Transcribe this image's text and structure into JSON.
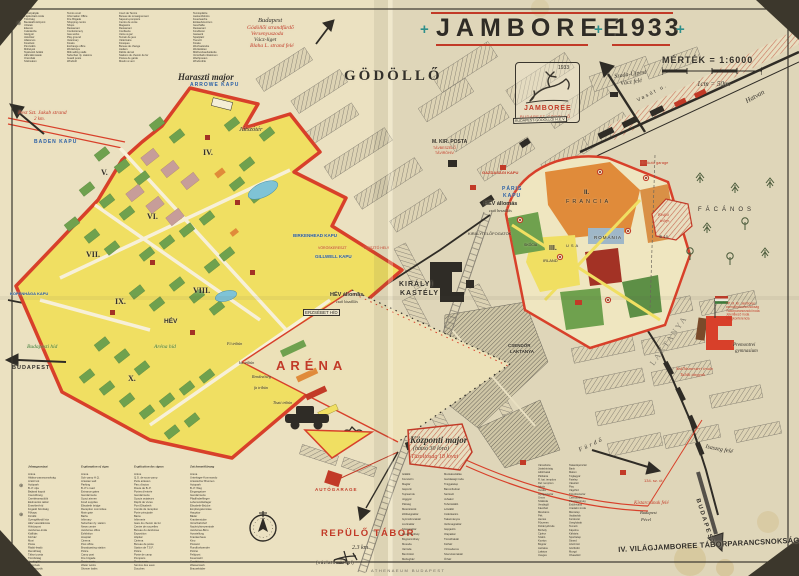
{
  "palette": {
    "paper": "#e8dfc1",
    "photo_bg": "#3c372c",
    "red": "#c23a27",
    "teal": "#2f8f8a",
    "blue": "#2a5fa5",
    "camp_yellow": "#f0df62",
    "green": "#6fa14e",
    "orange": "#e08b3a",
    "ink": "#33302a"
  },
  "header": {
    "plus": "+",
    "title_word": "JAMBOREE",
    "title_year": "1933",
    "scale_label": "MÉRTÉK = 1:6000",
    "scale_note": "1cm = 50m.",
    "town": "GÖDÖLLŐ",
    "logo_year": "1933",
    "logo_name": "JAMBOREE",
    "logo_sub": "BUDAPEST-GÖDÖLLŐ"
  },
  "directions": {
    "top_l1": "Budapest",
    "top_l2": "Gödöllői strandfürdő",
    "top_l3": "Versenyuszoda",
    "top_l4": "Vácz-liget",
    "top_l5": "Blaha L. strand felé",
    "szada_l1": "Szada-Újpest",
    "szada_l2": "Vácz felé",
    "hatvan": "Hatvan",
    "vasut_street": "Vasút u.",
    "jakab_l1": "Pest Szt. Jakab strand",
    "jakab_l2": "2 km.",
    "isaszeg": "Isaszeg felé",
    "budapest_left": "BUDAPEST",
    "budapest_right": "BUDAPEST",
    "kistarcsa": "Kistarcsának felé",
    "kistarcsa_sub1": "Budapest",
    "kistarcsa_sub2": "Pécel",
    "road134": "134. sz. út"
  },
  "camp": {
    "major": "Haraszti major",
    "playground": "Játszótér",
    "regions": [
      "IV.",
      "V.",
      "VI.",
      "VII.",
      "VIII.",
      "IX.",
      "X."
    ],
    "arena": "ARÉNA",
    "arena_bridge": "Aréna híd",
    "budapest_bridge": "Budapesti híd",
    "hev": "HÉV",
    "hev_out": "HÉV állomás",
    "hev_out_note": "csak kiszállás",
    "erzsebet_bridge": "ERZSÉBET HÍD",
    "tribunes": [
      "Fő tribün",
      "kis tribün",
      "Rendezőség",
      "fa tribün",
      "Tiszti tribün"
    ]
  },
  "gates": {
    "arrowe": "ARROWE KAPU",
    "baden": "BADEN KAPU",
    "kopenhaga": "KOPENHÁGA KAPU",
    "birkenhead": "BIRKENHEAD KAPU",
    "gillwell": "GILLWELL KAPU",
    "voroskereszt": "VÖRÖSKERESZT",
    "kioszto": "KIOSZTÓ HELY",
    "paris_1": "PÁRIS",
    "paris_2": "KAPU",
    "gazdasagi": "GAZDASÁGI KAPU"
  },
  "town": {
    "castle_1": "KIRÁLYI",
    "castle_2": "KASTÉLY",
    "posta": "M. KIR. POSTA",
    "posta_red_1": "TÁVBESZÉLŐ",
    "posta_red_2": "TÁVIRÓHIV.",
    "hev_in": "HÉV állomás",
    "hev_in_note": "csak beszállás",
    "hev_line_box": "BUDAPEST-GÖDÖLLŐI H.É.V.",
    "elofogatok": "KIRÁLYI ELŐFOGATOK",
    "csendor_1": "CSENDŐR",
    "csendor_2": "LAKTANYA",
    "laktanya_big": "LAKTANYA",
    "furdo_street": "Fürdő",
    "facanos": "FÁCÁNOS",
    "kisfiu_1": "Kisfiú",
    "kisfiu_2": "telep.",
    "marker10": "⊛ 10.",
    "tp_garage": "TP. Autó garage",
    "francia": "FRANCIA",
    "francia_num": "II.",
    "romania": "ROMÁNIA",
    "camp3_num": "III.",
    "camp3": "IRLAND",
    "usa": "USA",
    "skocia": "SKÓCIA",
    "tp_hq": [
      "TP. M. kir. Jamboree",
      "csendőrparancsnokság",
      "Táborparancsnoki iroda",
      "Jelentkező iroda",
      "Világkonferencia"
    ],
    "gimnazium_1": "Premontrei",
    "gimnazium_2": "gymnasium",
    "szallas_1": "Szállásmesteri iroda",
    "szallas_2": "Talált tárgyak"
  },
  "bottom": {
    "kozponti": "Központi major",
    "kozponti_2": "(hátsó 30 lóra)",
    "kozponti_3": "Tüzoltóság 18 lovai",
    "autogarage": "AUTÓGARAGE",
    "repulo": "REPÜLŐ TÁBOR",
    "repulo_km": "2.3 km",
    "repulo_note": "(vázlaton kívül)",
    "printer": "ATHENAEUM BUDAPEST",
    "command": "IV. VILÁGJAMBOREE TÁBORPARANCSNOKSÁG"
  },
  "legend_top": {
    "hu": [
      "Teniszpályák",
      "Tájékoztató iroda",
      "Tűzőrség",
      "Bevásárló központ",
      "Üzletek",
      "Étterem",
      "Cukrászda",
      "Gázgyár",
      "Játszótér",
      "Állatorvos",
      "Kioszkok",
      "Pénzváltó",
      "Műhelyek",
      "Tejárusító bódék",
      "HÉV-állomások",
      "Őrszobák",
      "Szélmalom"
    ],
    "en": [
      "Tennis court",
      "Information Office",
      "Fire Brigade",
      "Shopping centre",
      "Shops",
      "Restaurant",
      "Confectionery",
      "Gas works",
      "Play ground",
      "Veterinary",
      "Kiosks",
      "Exchange office",
      "Workshops",
      "Milk selling stalls",
      "Suburban rly. stations",
      "Guard posts",
      "Windmill"
    ],
    "fr": [
      "Court de Tennis",
      "Bureau de renseignement",
      "Sapeurs-pompiers",
      "Centre de vente",
      "Magasins",
      "Restaurant",
      "Confiserie",
      "Usine à gaz",
      "Terrain de jeux",
      "Vétérinaire",
      "Kiosques",
      "Bureau de change",
      "Ateliers",
      "Débits de lait",
      "Stations du chemin de fer",
      "Postes de garde",
      "Moulin à vent"
    ],
    "de": [
      "Tennisplätze",
      "Auskunftsbüro",
      "Feuerwache",
      "Einkaufszentrum",
      "Geschäfte",
      "Restaurant",
      "Konditorei",
      "Gaswerk",
      "Spielplatz",
      "Tierarzt",
      "Kioske",
      "Wechselstube",
      "Werkstätten",
      "Milchverkaufsstände",
      "Vorortbahn-Stationen",
      "Wachposten",
      "Windmühle"
    ]
  },
  "legend_bottom": {
    "headers": [
      "Jelmagyarázat",
      "Explanation of signs",
      "Explication des signes",
      "Zeichenerklärung"
    ],
    "hu": [
      "Aréna",
      "Altábor-parancsnokság",
      "Artézi kút",
      "Autópark",
      "B.-P. útja",
      "Bejárati kapuk",
      "Csendőrség",
      "Cserkészrepülők",
      "Élelmezési raktár",
      "Erzsébet-híd",
      "Fogadó bizottság",
      "Főkapu",
      "Fürdők",
      "Gyengélkedő ház",
      "HÉV vasútállomás",
      "Hírközpont",
      "Jamboree-iroda",
      "Kiállítás",
      "Kórház",
      "Mozi",
      "Posta",
      "Rádió-leadó",
      "Rendőrség",
      "Tábori posta",
      "Tüzoltóság",
      "Vendéglők",
      "Vízművek",
      "Zuhanyozók"
    ],
    "en": [
      "Arena",
      "Sub-camp H.Q.",
      "Artesian well",
      "Parking",
      "B.-P.'s road",
      "Entrance gates",
      "Gendarmerie",
      "Scout airmen",
      "Food supplies",
      "Elisabeth bridge",
      "Reception committee",
      "Main gate",
      "Baths",
      "Infirmary",
      "Suburban rly. station",
      "News centre",
      "Jamboree office",
      "Exhibition",
      "Hospital",
      "Cinema",
      "Post office",
      "Broadcasting station",
      "Police",
      "Camp post",
      "Fire brigade",
      "Restaurants",
      "Water works",
      "Shower baths"
    ],
    "fr": [
      "Arène",
      "Q.G. de sous-camp",
      "Puits artésien",
      "Parc d'autos",
      "Route de B.-P.",
      "Portes d'entrée",
      "Gendarmerie",
      "Scouts aviateurs",
      "Dépôt de vivres",
      "Pont Elisabeth",
      "Comité de réception",
      "Porte principale",
      "Bains",
      "Infirmerie",
      "Gare du chemin de fer",
      "Centre de nouvelles",
      "Bureau du Jamboree",
      "Exposition",
      "Hôpital",
      "Cinéma",
      "Bureau de poste",
      "Station de T.S.F.",
      "Police",
      "Poste de camp",
      "Pompiers",
      "Restaurants",
      "Service des eaux",
      "Douches"
    ],
    "de": [
      "Arena",
      "Unterlager-Kommando",
      "Artesischer Brunnen",
      "Autopark",
      "B.-P. Weg",
      "Eingangstore",
      "Gendarmerie",
      "Pfadfinderflieger",
      "Lebensmittellager",
      "Elisabeth-Brücke",
      "Empfangskomitee",
      "Haupttor",
      "Bäder",
      "Krankenstube",
      "Vorortbahnhof",
      "Nachrichtenzentrale",
      "Jamboree-Büro",
      "Ausstellung",
      "Krankenhaus",
      "Kino",
      "Postamt",
      "Rundfunksender",
      "Polizei",
      "Feldpost",
      "Feuerwehr",
      "Gasthäuser",
      "Wasserwerk",
      "Brausebäder"
    ]
  },
  "list_center": {
    "col1": [
      "Istállók",
      "Kocsiszín",
      "Magtár",
      "Gépszín",
      "Tejcsarnok",
      "Jéggyár",
      "Pékség",
      "Mészárszék",
      "Zöldségraktár",
      "Gyümölcsraktár",
      "Lisztraktár",
      "Szénaraktár",
      "Kovácsműhely",
      "Bognárműhely",
      "Mosoda",
      "Varroda",
      "Benzinkút",
      "Mérlegház"
    ],
    "col2": [
      "Munkásszállás",
      "Gazdasági iroda",
      "Trágyatelep",
      "Baromfiudvar",
      "Sertésól",
      "Juhakol",
      "Tehénistálló",
      "Lóistálló",
      "Csikókarám",
      "Takarmányos",
      "Vetőmagraktár",
      "Gépjavító",
      "Olajraktár",
      "Tüzelőraktár",
      "Kútház",
      "Vízmedence",
      "Szerszámraktár",
      "Őrház"
    ]
  },
  "list_right": {
    "col1": [
      "Városháza",
      "Járásbíróság",
      "Adóhivatal",
      "Plébánia",
      "R. kat. templom",
      "Ref. templom",
      "Iskola",
      "Óvoda",
      "Gyógyszertár",
      "Orvos",
      "Szálloda",
      "Vendéglő",
      "Kávéház",
      "Mészáros",
      "Pék",
      "Hentes",
      "Fűszeres",
      "Dohánytőzsde",
      "Borbély",
      "Cipész",
      "Szabó",
      "Kovács",
      "Bognár",
      "Asztalos",
      "Lakatos",
      "Üveges"
    ],
    "col2": [
      "Takarékpénztár",
      "Bank",
      "Malom",
      "Téglagyár",
      "Fatelep",
      "Vásártér",
      "Piac",
      "Vágóhíd",
      "Tűzoltószertár",
      "Csendőrőrs",
      "Pénzügyőrség",
      "Erdőhivatal",
      "Uradalmi iroda",
      "Méntelep",
      "Vadászlak",
      "Kertészet",
      "Üvegházak",
      "Temető",
      "Kápolna",
      "Kálvária",
      "Sporttelep",
      "Strand",
      "Artézi kút",
      "Gőzfürdő",
      "Mozgó",
      "Olvasókör"
    ]
  }
}
